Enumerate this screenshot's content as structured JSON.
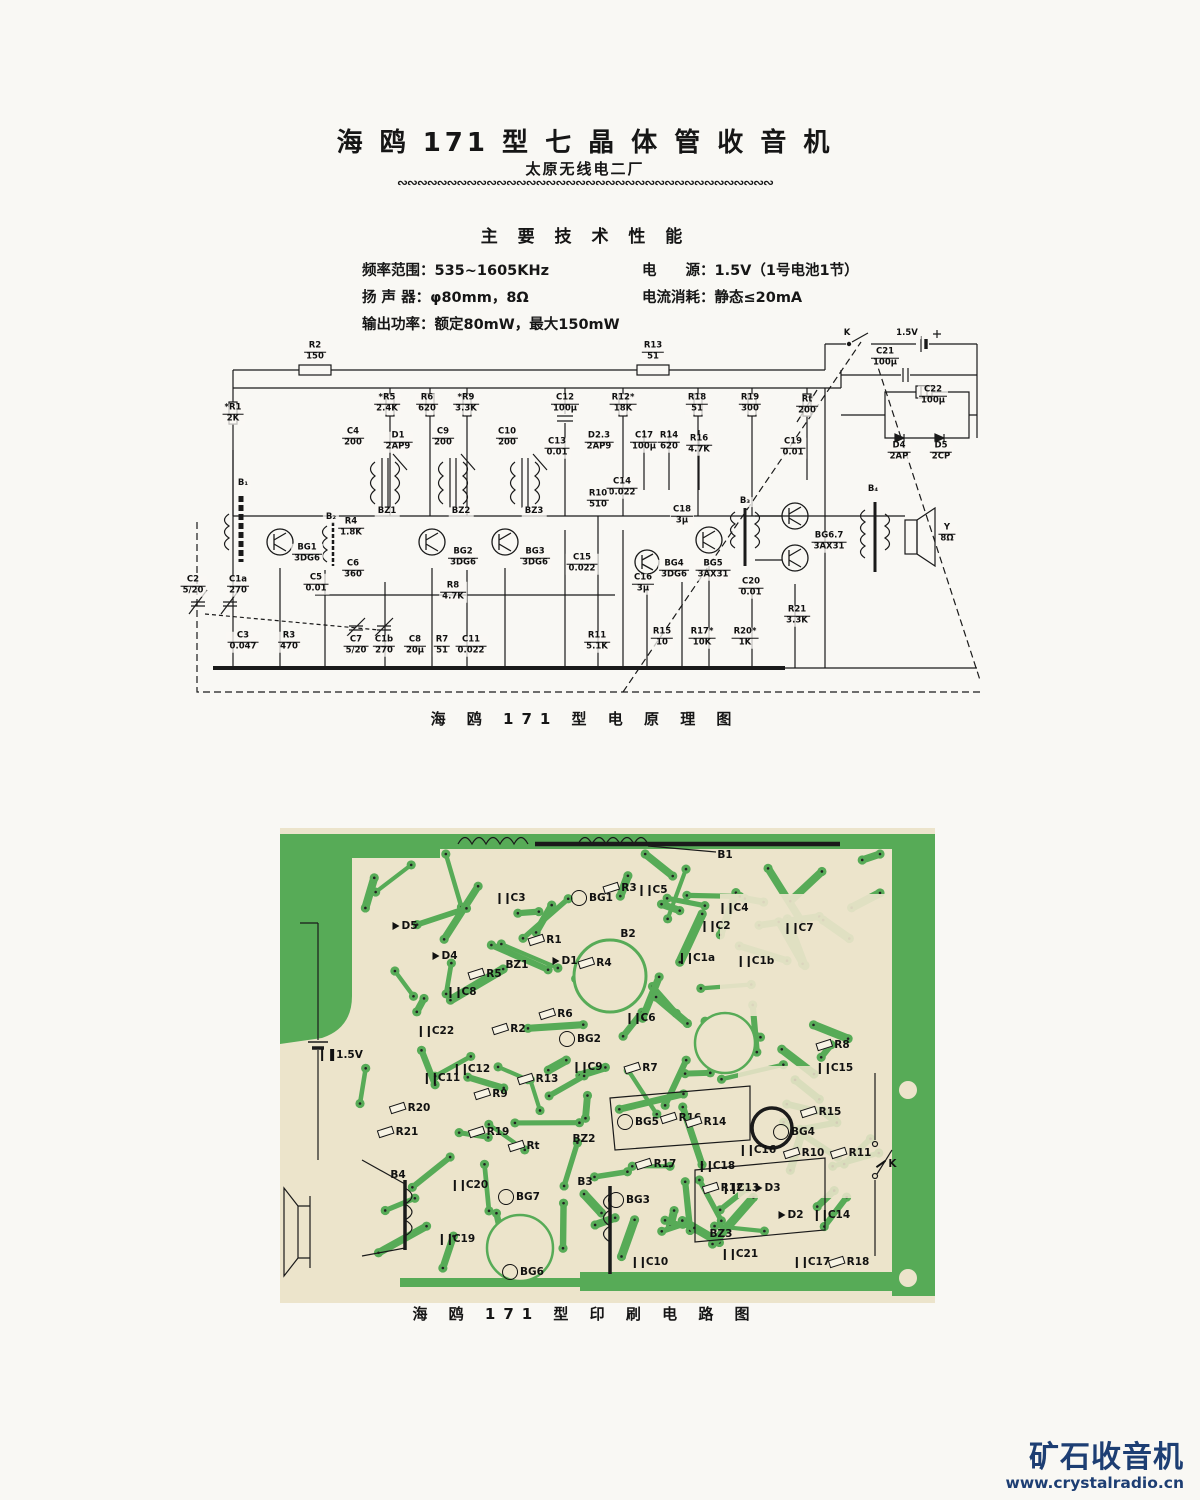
{
  "header": {
    "title": "海 鸥 171 型 七 晶 体 管 收 音 机",
    "subtitle": "太原无线电二厂",
    "divider": "∾∾∾∾∾∾∾∾∾∾∾∾∾∾∾∾∾∾∾∾∾∾∾∾∾∾∾∾∾∾∾∾∾∾∾∾∾∾"
  },
  "specs": {
    "heading": "主 要 技 术 性 能",
    "left_lines": "频率范围：535~1605KHz\n扬 声 器：φ80mm，8Ω\n输出功率：额定80mW，最大150mW",
    "right_lines": "电　　源：1.5V（1号电池1节）\n电流消耗：静态≤20mA"
  },
  "schematic": {
    "caption": "海 鸥 171 型 电 原 理 图",
    "components": [
      {
        "name": "R2",
        "value": "150",
        "x": 130,
        "y": 22
      },
      {
        "name": "R13",
        "value": "51",
        "x": 468,
        "y": 22
      },
      {
        "name": "K",
        "value": "",
        "x": 662,
        "y": 4
      },
      {
        "name": "1.5V",
        "value": "",
        "x": 722,
        "y": 4
      },
      {
        "name": "C21",
        "value": "100μ",
        "x": 700,
        "y": 28
      },
      {
        "name": "*R1",
        "value": "2K",
        "x": 48,
        "y": 84
      },
      {
        "name": "*R5",
        "value": "2.4K",
        "x": 202,
        "y": 74
      },
      {
        "name": "R6",
        "value": "620",
        "x": 242,
        "y": 74
      },
      {
        "name": "*R9",
        "value": "3.3K",
        "x": 281,
        "y": 74
      },
      {
        "name": "C12",
        "value": "100μ",
        "x": 380,
        "y": 74
      },
      {
        "name": "R12*",
        "value": "18K",
        "x": 438,
        "y": 74
      },
      {
        "name": "R18",
        "value": "51",
        "x": 512,
        "y": 74
      },
      {
        "name": "R19",
        "value": "300",
        "x": 565,
        "y": 74
      },
      {
        "name": "Rt",
        "value": "200",
        "x": 622,
        "y": 76
      },
      {
        "name": "C22",
        "value": "100μ",
        "x": 748,
        "y": 66
      },
      {
        "name": "D4",
        "value": "2AP",
        "x": 714,
        "y": 122
      },
      {
        "name": "D5",
        "value": "2CP",
        "x": 756,
        "y": 122
      },
      {
        "name": "C4",
        "value": "200",
        "x": 168,
        "y": 108
      },
      {
        "name": "D1",
        "value": "2AP9",
        "x": 213,
        "y": 112
      },
      {
        "name": "C9",
        "value": "200",
        "x": 258,
        "y": 108
      },
      {
        "name": "C10",
        "value": "200",
        "x": 322,
        "y": 108
      },
      {
        "name": "C13",
        "value": "0.01",
        "x": 372,
        "y": 118
      },
      {
        "name": "D2.3",
        "value": "2AP9",
        "x": 414,
        "y": 112
      },
      {
        "name": "C17",
        "value": "100μ",
        "x": 459,
        "y": 112
      },
      {
        "name": "R14",
        "value": "620",
        "x": 484,
        "y": 112
      },
      {
        "name": "R16",
        "value": "4.7K",
        "x": 514,
        "y": 115
      },
      {
        "name": "C19",
        "value": "0.01",
        "x": 608,
        "y": 118
      },
      {
        "name": "C14",
        "value": "0.022",
        "x": 437,
        "y": 158
      },
      {
        "name": "R10",
        "value": "510",
        "x": 413,
        "y": 170
      },
      {
        "name": "BZ1",
        "value": "",
        "x": 202,
        "y": 182
      },
      {
        "name": "BZ2",
        "value": "",
        "x": 276,
        "y": 182
      },
      {
        "name": "BZ3",
        "value": "",
        "x": 349,
        "y": 182
      },
      {
        "name": "B₁",
        "value": "",
        "x": 58,
        "y": 154
      },
      {
        "name": "B₂",
        "value": "",
        "x": 146,
        "y": 188
      },
      {
        "name": "B₃",
        "value": "",
        "x": 560,
        "y": 172
      },
      {
        "name": "B₄",
        "value": "",
        "x": 688,
        "y": 160
      },
      {
        "name": "R4",
        "value": "1.8K",
        "x": 166,
        "y": 198
      },
      {
        "name": "C18",
        "value": "3μ",
        "x": 497,
        "y": 186
      },
      {
        "name": "BG1",
        "value": "3DG6",
        "x": 122,
        "y": 224
      },
      {
        "name": "BG2",
        "value": "3DG6",
        "x": 278,
        "y": 228
      },
      {
        "name": "BG3",
        "value": "3DG6",
        "x": 350,
        "y": 228
      },
      {
        "name": "BG4",
        "value": "3DG6",
        "x": 489,
        "y": 240
      },
      {
        "name": "BG5",
        "value": "3AX31",
        "x": 528,
        "y": 240
      },
      {
        "name": "BG6.7",
        "value": "3AX31",
        "x": 644,
        "y": 212
      },
      {
        "name": "Y",
        "value": "8Ω",
        "x": 762,
        "y": 204
      },
      {
        "name": "C15",
        "value": "0.022",
        "x": 397,
        "y": 234
      },
      {
        "name": "C6",
        "value": "360",
        "x": 168,
        "y": 240
      },
      {
        "name": "C5",
        "value": "0.01",
        "x": 131,
        "y": 254
      },
      {
        "name": "C2",
        "value": "5/20",
        "x": 8,
        "y": 256
      },
      {
        "name": "C1a",
        "value": "270",
        "x": 53,
        "y": 256
      },
      {
        "name": "C16",
        "value": "3μ",
        "x": 458,
        "y": 254
      },
      {
        "name": "C20",
        "value": "0.01",
        "x": 566,
        "y": 258
      },
      {
        "name": "R8",
        "value": "4.7K",
        "x": 268,
        "y": 262
      },
      {
        "name": "R21",
        "value": "3.3K",
        "x": 612,
        "y": 286
      },
      {
        "name": "C3",
        "value": "0.047",
        "x": 58,
        "y": 312
      },
      {
        "name": "R3",
        "value": "470",
        "x": 104,
        "y": 312
      },
      {
        "name": "C7",
        "value": "5/20",
        "x": 171,
        "y": 316
      },
      {
        "name": "C1b",
        "value": "270",
        "x": 199,
        "y": 316
      },
      {
        "name": "C8",
        "value": "20μ",
        "x": 230,
        "y": 316
      },
      {
        "name": "R7",
        "value": "51",
        "x": 257,
        "y": 316
      },
      {
        "name": "C11",
        "value": "0.022",
        "x": 286,
        "y": 316
      },
      {
        "name": "R11",
        "value": "5.1K",
        "x": 412,
        "y": 312
      },
      {
        "name": "R15",
        "value": "10",
        "x": 477,
        "y": 308
      },
      {
        "name": "R17*",
        "value": "10K",
        "x": 517,
        "y": 308
      },
      {
        "name": "R20*",
        "value": "1K",
        "x": 560,
        "y": 308
      }
    ]
  },
  "pcb": {
    "caption": "海 鸥 171 型 印 刷 电 路 图",
    "labels": [
      {
        "name": "B1",
        "t": "coil",
        "x": 445,
        "y": 27
      },
      {
        "name": "C3",
        "t": "c",
        "x": 232,
        "y": 70
      },
      {
        "name": "BG1",
        "t": "q",
        "x": 312,
        "y": 70
      },
      {
        "name": "R3",
        "t": "r",
        "x": 340,
        "y": 60
      },
      {
        "name": "C5",
        "t": "c",
        "x": 374,
        "y": 62
      },
      {
        "name": "C4",
        "t": "c",
        "x": 455,
        "y": 80
      },
      {
        "name": "D5",
        "t": "d",
        "x": 125,
        "y": 98
      },
      {
        "name": "R1",
        "t": "r",
        "x": 265,
        "y": 112
      },
      {
        "name": "C2",
        "t": "c",
        "x": 437,
        "y": 98
      },
      {
        "name": "C7",
        "t": "c",
        "x": 520,
        "y": 100
      },
      {
        "name": "D4",
        "t": "d",
        "x": 165,
        "y": 128
      },
      {
        "name": "BZ1",
        "t": "coil",
        "x": 237,
        "y": 137
      },
      {
        "name": "D1",
        "t": "d",
        "x": 285,
        "y": 133
      },
      {
        "name": "R4",
        "t": "r",
        "x": 315,
        "y": 135
      },
      {
        "name": "B2",
        "t": "coil",
        "x": 348,
        "y": 106
      },
      {
        "name": "R5",
        "t": "r",
        "x": 205,
        "y": 146
      },
      {
        "name": "C1a",
        "t": "c",
        "x": 418,
        "y": 130
      },
      {
        "name": "C1b",
        "t": "c",
        "x": 477,
        "y": 133
      },
      {
        "name": "C8",
        "t": "c",
        "x": 183,
        "y": 164
      },
      {
        "name": "R6",
        "t": "r",
        "x": 276,
        "y": 186
      },
      {
        "name": "C6",
        "t": "c",
        "x": 362,
        "y": 190
      },
      {
        "name": "C22",
        "t": "c",
        "x": 157,
        "y": 203
      },
      {
        "name": "R2",
        "t": "r",
        "x": 229,
        "y": 201
      },
      {
        "name": "BG2",
        "t": "q",
        "x": 300,
        "y": 211
      },
      {
        "name": "1.5V",
        "t": "bat",
        "x": 62,
        "y": 227
      },
      {
        "name": "R8",
        "t": "r",
        "x": 553,
        "y": 217
      },
      {
        "name": "C15",
        "t": "c",
        "x": 556,
        "y": 240
      },
      {
        "name": "C12",
        "t": "c",
        "x": 193,
        "y": 241
      },
      {
        "name": "C11",
        "t": "c",
        "x": 163,
        "y": 250
      },
      {
        "name": "R13",
        "t": "r",
        "x": 258,
        "y": 251
      },
      {
        "name": "C9",
        "t": "c",
        "x": 309,
        "y": 239
      },
      {
        "name": "R7",
        "t": "r",
        "x": 361,
        "y": 240
      },
      {
        "name": "R9",
        "t": "r",
        "x": 211,
        "y": 266
      },
      {
        "name": "R20",
        "t": "r",
        "x": 130,
        "y": 280
      },
      {
        "name": "R21",
        "t": "r",
        "x": 118,
        "y": 304
      },
      {
        "name": "R19",
        "t": "r",
        "x": 209,
        "y": 304
      },
      {
        "name": "Rt",
        "t": "r",
        "x": 244,
        "y": 318
      },
      {
        "name": "BZ2",
        "t": "coil",
        "x": 304,
        "y": 311
      },
      {
        "name": "BG5",
        "t": "q",
        "x": 358,
        "y": 294
      },
      {
        "name": "R16",
        "t": "r",
        "x": 401,
        "y": 290
      },
      {
        "name": "R14",
        "t": "r",
        "x": 426,
        "y": 294
      },
      {
        "name": "R15",
        "t": "r",
        "x": 541,
        "y": 284
      },
      {
        "name": "BG4",
        "t": "q",
        "x": 514,
        "y": 304
      },
      {
        "name": "R17",
        "t": "r",
        "x": 376,
        "y": 336
      },
      {
        "name": "R10",
        "t": "r",
        "x": 524,
        "y": 325
      },
      {
        "name": "R11",
        "t": "r",
        "x": 571,
        "y": 325
      },
      {
        "name": "K",
        "t": "sw",
        "x": 606,
        "y": 336
      },
      {
        "name": "B4",
        "t": "coil",
        "x": 118,
        "y": 347
      },
      {
        "name": "C20",
        "t": "c",
        "x": 191,
        "y": 357
      },
      {
        "name": "C16",
        "t": "c",
        "x": 479,
        "y": 322
      },
      {
        "name": "C18",
        "t": "c",
        "x": 438,
        "y": 338
      },
      {
        "name": "BG7",
        "t": "q",
        "x": 239,
        "y": 369
      },
      {
        "name": "B3",
        "t": "coil",
        "x": 305,
        "y": 354
      },
      {
        "name": "BG3",
        "t": "q",
        "x": 349,
        "y": 372
      },
      {
        "name": "R12",
        "t": "r",
        "x": 443,
        "y": 360
      },
      {
        "name": "C13",
        "t": "c",
        "x": 462,
        "y": 360
      },
      {
        "name": "D3",
        "t": "d",
        "x": 488,
        "y": 360
      },
      {
        "name": "D2",
        "t": "d",
        "x": 511,
        "y": 387
      },
      {
        "name": "C14",
        "t": "c",
        "x": 553,
        "y": 387
      },
      {
        "name": "C19",
        "t": "c",
        "x": 178,
        "y": 411
      },
      {
        "name": "BZ3",
        "t": "coil",
        "x": 441,
        "y": 406
      },
      {
        "name": "C21",
        "t": "c",
        "x": 461,
        "y": 426
      },
      {
        "name": "C10",
        "t": "c",
        "x": 371,
        "y": 434
      },
      {
        "name": "BG6",
        "t": "q",
        "x": 243,
        "y": 444
      },
      {
        "name": "C17",
        "t": "c",
        "x": 533,
        "y": 434
      },
      {
        "name": "R18",
        "t": "r",
        "x": 569,
        "y": 434
      }
    ],
    "trace_color": "#57ab57",
    "board_color": "#ece4cb"
  },
  "watermark": {
    "brand": "矿石收音机",
    "site": "www.crystalradio.cn",
    "color": "#1d3e73"
  }
}
